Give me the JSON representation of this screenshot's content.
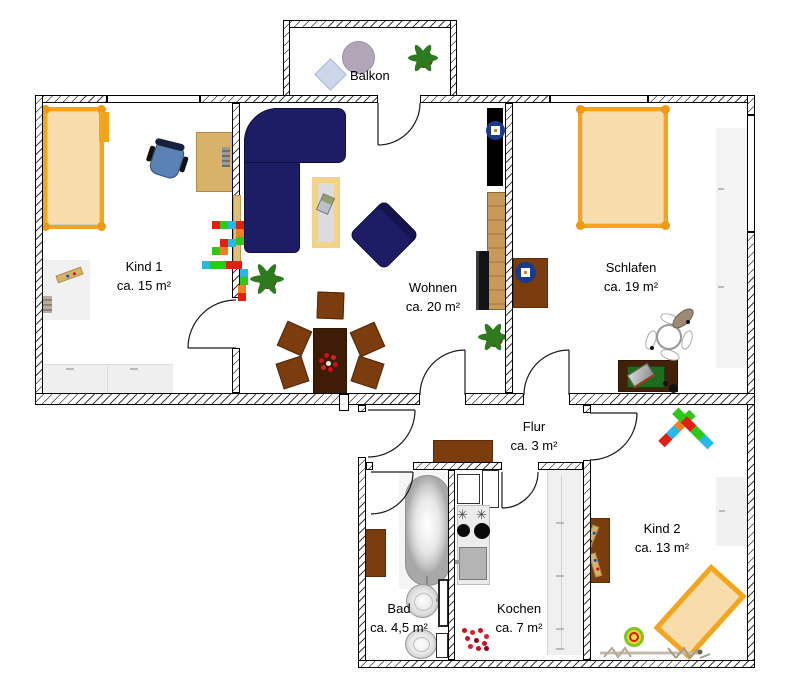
{
  "rooms": {
    "balkon": {
      "name": "Balkon"
    },
    "kind1": {
      "name": "Kind 1",
      "area": "ca. 15 m²"
    },
    "wohnen": {
      "name": "Wohnen",
      "area": "ca. 20 m²"
    },
    "schlafen": {
      "name": "Schlafen",
      "area": "ca. 19 m²"
    },
    "flur": {
      "name": "Flur",
      "area": "ca. 3 m²"
    },
    "bad": {
      "name": "Bad",
      "area": "ca. 4,5 m²"
    },
    "kochen": {
      "name": "Kochen",
      "area": "ca. 7 m²"
    },
    "kind2": {
      "name": "Kind 2",
      "area": "ca. 13 m²"
    }
  },
  "icons": {
    "burner": "✳"
  },
  "palette": {
    "bed_frame": "#f2a51d",
    "bed_fill": "#f8dcab",
    "sofa": "#1d1d66",
    "wood_light": "#d9b26a",
    "wood_mid": "#c89a5a",
    "wood_brown": "#7b3c0e",
    "wood_dark": "#3f1c05",
    "chair_blue": "#5b82b5",
    "stool_blue": "#1a3a8c",
    "plant_green": "#2d7a1f",
    "pot_brown": "#7a4a1f",
    "appliance_gray": "#ececec",
    "flower_red": "#c81020",
    "lego_red": "#e02010",
    "lego_green": "#2ec818",
    "lego_blue": "#28b8e8",
    "lego_orange": "#f08020"
  }
}
